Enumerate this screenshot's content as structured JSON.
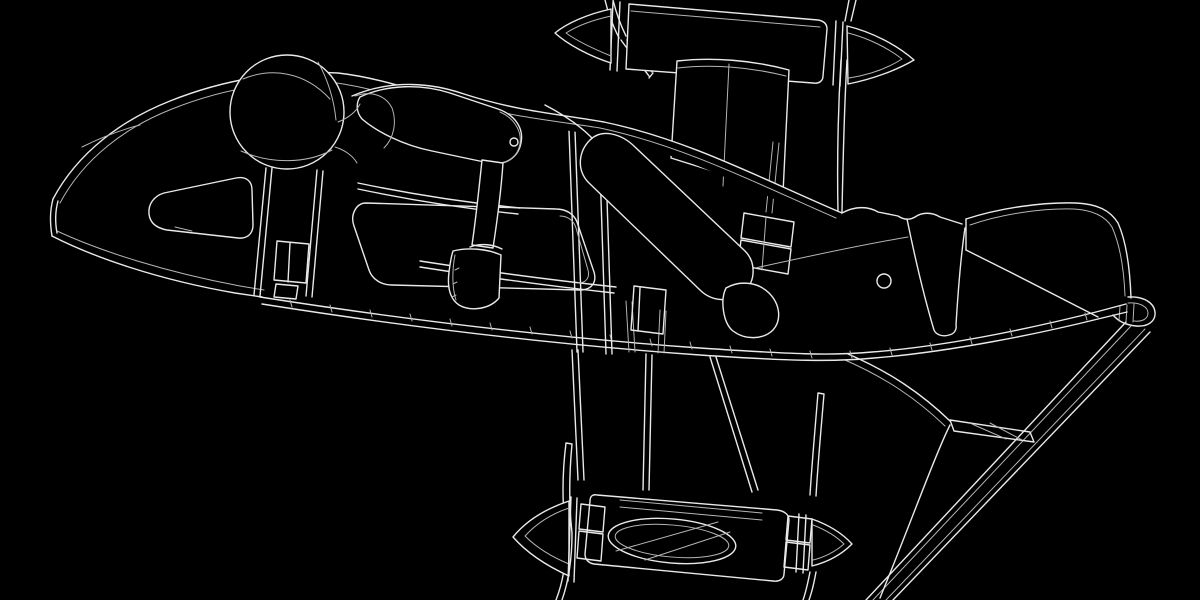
{
  "meta": {
    "title": "Wireframe line-art: pilot lying prone on a twin-nacelle flying-wing craft",
    "description": "White outline CAD-style illustration on a black background. A helmeted figure lies face-down along the center of a swept flying wing. A propeller nacelle with pointed spinner cones sits above the wing (top center) and another below it (bottom center), joined by struts. The nose fairing at left has a triangular window cutout; the right wing sweeps to a curled tip with a diagonal brace running to the lower edge.",
    "style": "technical outline / wireframe drawing",
    "background_color": "#000000",
    "line_color": "#e9e9e9",
    "secondary_line_color": "#b5b5b5"
  },
  "canvas": {
    "width": 1200,
    "height": 600
  },
  "components": [
    {
      "id": "nose-fairing",
      "label": "Nose fairing with triangular window cutout"
    },
    {
      "id": "helmet",
      "label": "Pilot helmet with seam lines"
    },
    {
      "id": "pilot-body",
      "label": "Prone pilot torso, arms with fists, hip and bent leg"
    },
    {
      "id": "upper-nacelle",
      "label": "Upper propeller nacelle with spinner cones and blades"
    },
    {
      "id": "lower-nacelle",
      "label": "Lower propeller nacelle with elliptical cutout and braces"
    },
    {
      "id": "main-wing",
      "label": "Main wing with segmented trailing edge"
    },
    {
      "id": "right-wing-panel",
      "label": "Outer right wing panel with curled wingtip"
    },
    {
      "id": "wingtip-braces",
      "label": "Diagonal braces from wingtip to lower edge"
    },
    {
      "id": "support-frame",
      "label": "Support frame rails, posts and boxes"
    }
  ]
}
